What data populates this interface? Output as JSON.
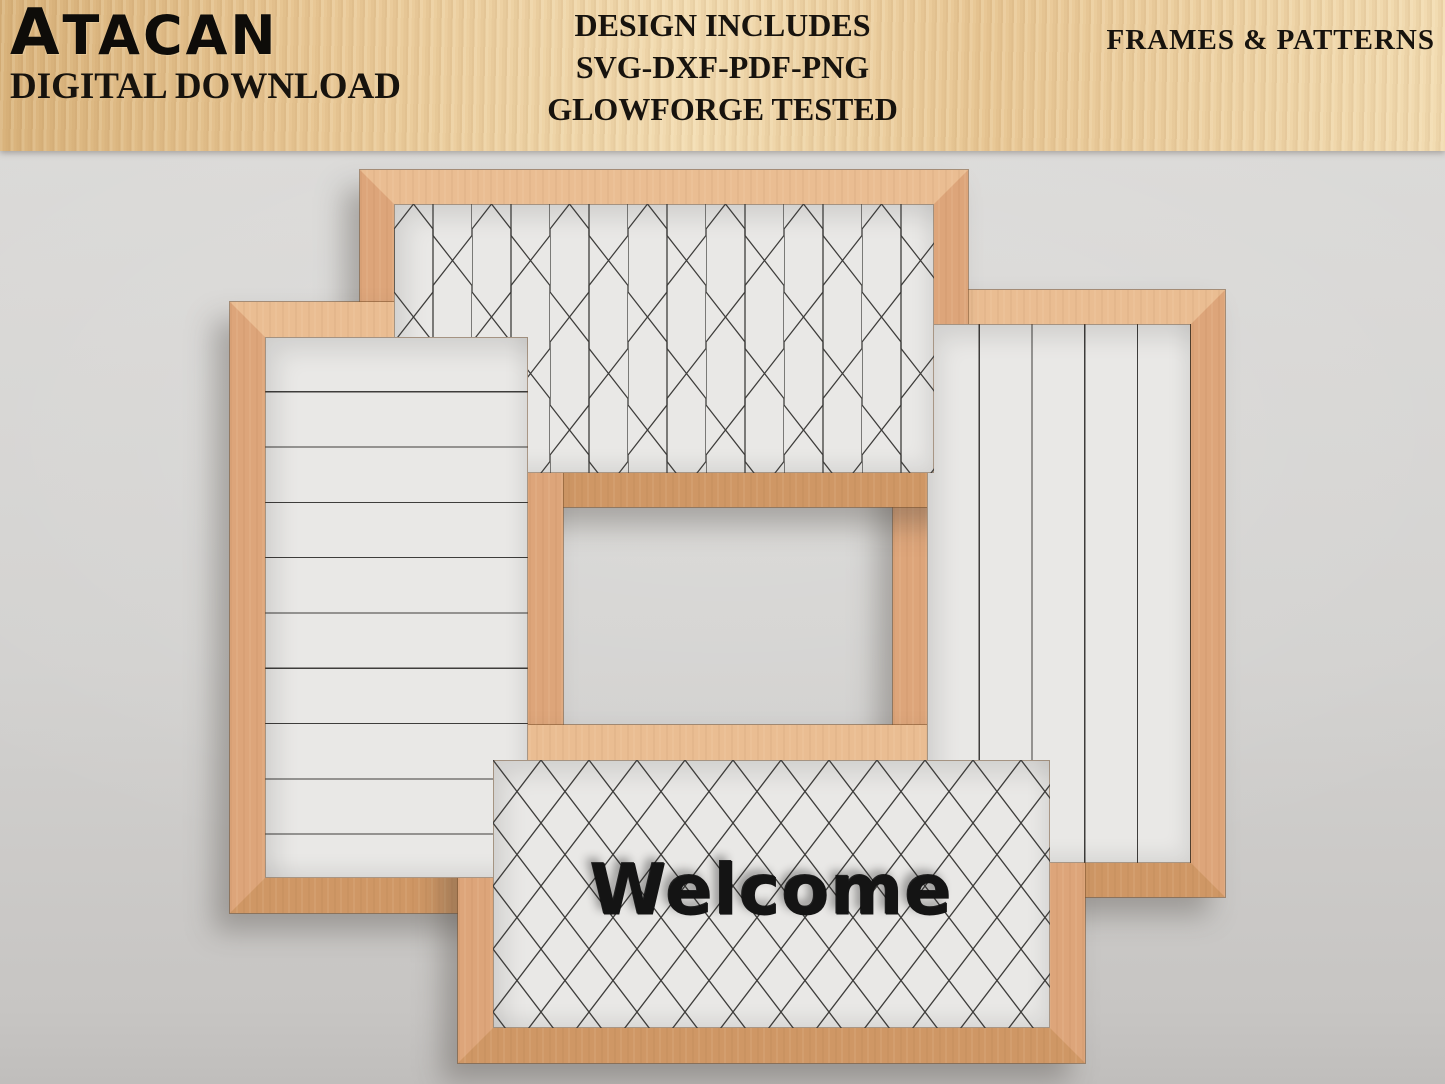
{
  "banner": {
    "logo_title": "ATACAN",
    "logo_subtitle": "DIGITAL DOWNLOAD",
    "center_lines": [
      "DESIGN INCLUDES",
      "SVG-DXF-PDF-PNG",
      "GLOWFORGE TESTED"
    ],
    "right_label": "FRAMES & PATTERNS"
  },
  "frames": [
    {
      "name": "vertical-planks-frame",
      "pattern": "vertical shiplap planks"
    },
    {
      "name": "hexagon-frame",
      "pattern": "elongated hexagon honeycomb"
    },
    {
      "name": "shiplap-frame",
      "pattern": "horizontal shiplap planks"
    },
    {
      "name": "welcome-frame",
      "pattern": "diagonal lattice",
      "text": "Welcome"
    }
  ],
  "colors": {
    "banner-wood": "#e8c795",
    "frame-wood": "#dda57a",
    "frame-wood-light": "#eabd92",
    "frame-wood-dark": "#cf9765",
    "bg-top": "#dad9d7",
    "bg-bottom": "#c7c5c3",
    "panel": "#e9e8e6",
    "pattern-line": "#3e3d3b",
    "text-dark": "#17130e",
    "welcome-color": "#141414"
  }
}
